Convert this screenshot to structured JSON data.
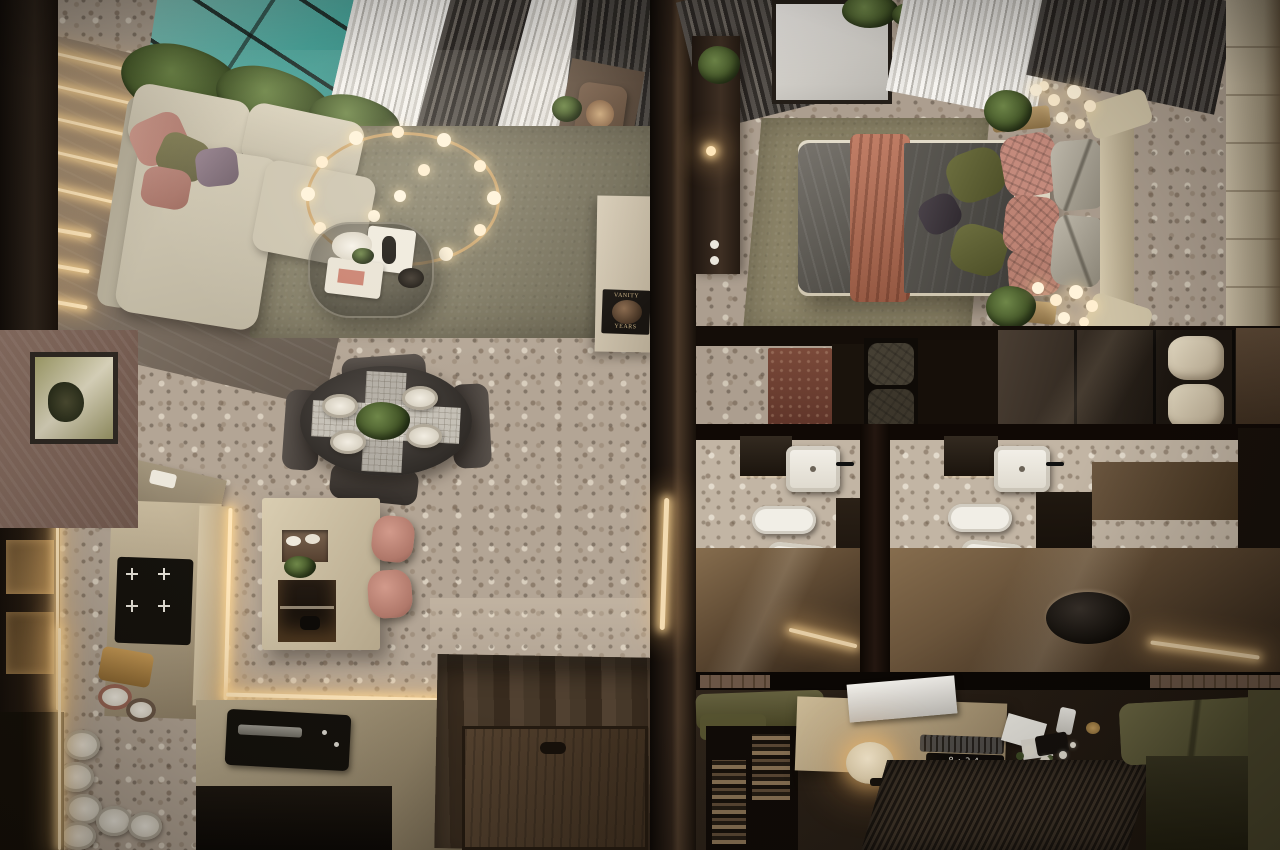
{
  "scene": {
    "description": "Photorealistic top-down bird's-eye 3D render of a compact apartment split by a dark central wall: left unit with living room, dining area and kitchen; right unit with bedroom, closet corridor, two mirrored bathrooms and a study nook.",
    "texts": {
      "coffee_table_book_line1": "VANITY",
      "coffee_table_book_line2": "YEARS",
      "desk_clock_time": "8:34"
    },
    "palette": {
      "terrazzo_floor": "#b3a595",
      "pool_water_teal": "#4ba79d",
      "sheer_curtain": "#e9e7e2",
      "dark_curtain": "#45403b",
      "wood_wall": "#867a6c",
      "led_warm_glow": "#ffe3b3",
      "sofa_greige": "#cfc7b2",
      "pillow_dusty_pink": "#c18e82",
      "pillow_olive": "#7c7850",
      "living_rug_olive": "#847e67",
      "chandelier_brass": "#caa36c",
      "dining_table_charcoal": "#3a3430",
      "kitchen_champagne": "#b5a78b",
      "island_marble": "#d9cdb1",
      "stool_blush": "#c08578",
      "entry_wood_floor": "#463829",
      "divider_wall": "#2c2017",
      "bed_duvet_gray": "#55524c",
      "bed_throw_terracotta": "#b06a55",
      "headboard_beige": "#cdc2a8",
      "bedroom_rug_olive": "#8d8569",
      "bath_gloss_floor": "#5f4a33",
      "bath_fixture_white": "#f2efe8",
      "vanity_dark_wood": "#241c14",
      "office_sofa_olive": "#5c5839",
      "desk_wood": "#cbb995",
      "office_rug_stripe": "#2a2219"
    },
    "rooms": {
      "left_unit": [
        "living-room",
        "dining-area",
        "kitchen",
        "entry"
      ],
      "right_unit": [
        "bedroom",
        "closet-corridor",
        "bathroom-left",
        "bathroom-right",
        "study-nook"
      ]
    }
  }
}
